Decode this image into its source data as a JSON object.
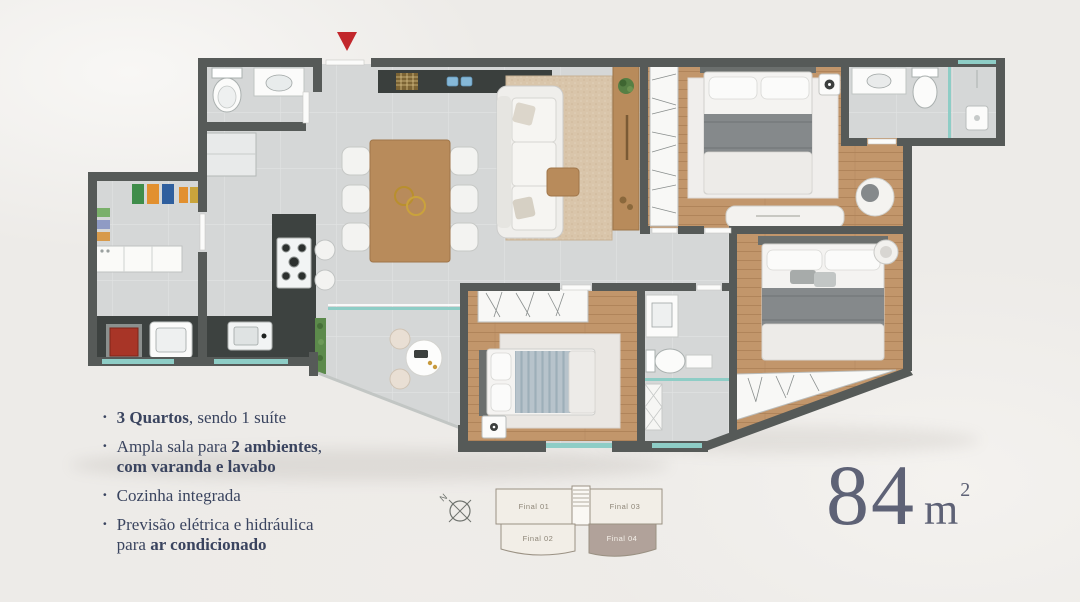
{
  "features": {
    "bullet": "·",
    "items": [
      {
        "lead_bold": "3 Quartos",
        "rest": ", sendo 1 suíte"
      },
      {
        "pre": "Ampla sala para ",
        "mid_bold": "2 ambientes",
        "post": ",",
        "line2_bold": "com varanda e lavabo"
      },
      {
        "text": "Cozinha integrada"
      },
      {
        "line1": "Previsão elétrica e hidráulica",
        "line2_pre": "para ",
        "line2_bold": "ar condicionado"
      }
    ]
  },
  "area_label": {
    "number": "84",
    "unit": "m",
    "exponent": "2"
  },
  "key_plan": {
    "compass": "N",
    "units": [
      {
        "label": "Final 01",
        "highlighted": false
      },
      {
        "label": "Final 02",
        "highlighted": false
      },
      {
        "label": "Final 03",
        "highlighted": false
      },
      {
        "label": "Final 04",
        "highlighted": true
      }
    ]
  },
  "colors": {
    "entrance_marker": "#c2272c",
    "wall": "#565a58",
    "counter_dark": "#3d4240",
    "tile_floor": "#d5d7d7",
    "wood_floor": "#c2966b",
    "glass_teal": "#8ecdc6",
    "text_navy": "#3a445f",
    "area_text": "#5e6276",
    "keyplan_highlight": "#b1a29a",
    "background": "#edebe8"
  }
}
